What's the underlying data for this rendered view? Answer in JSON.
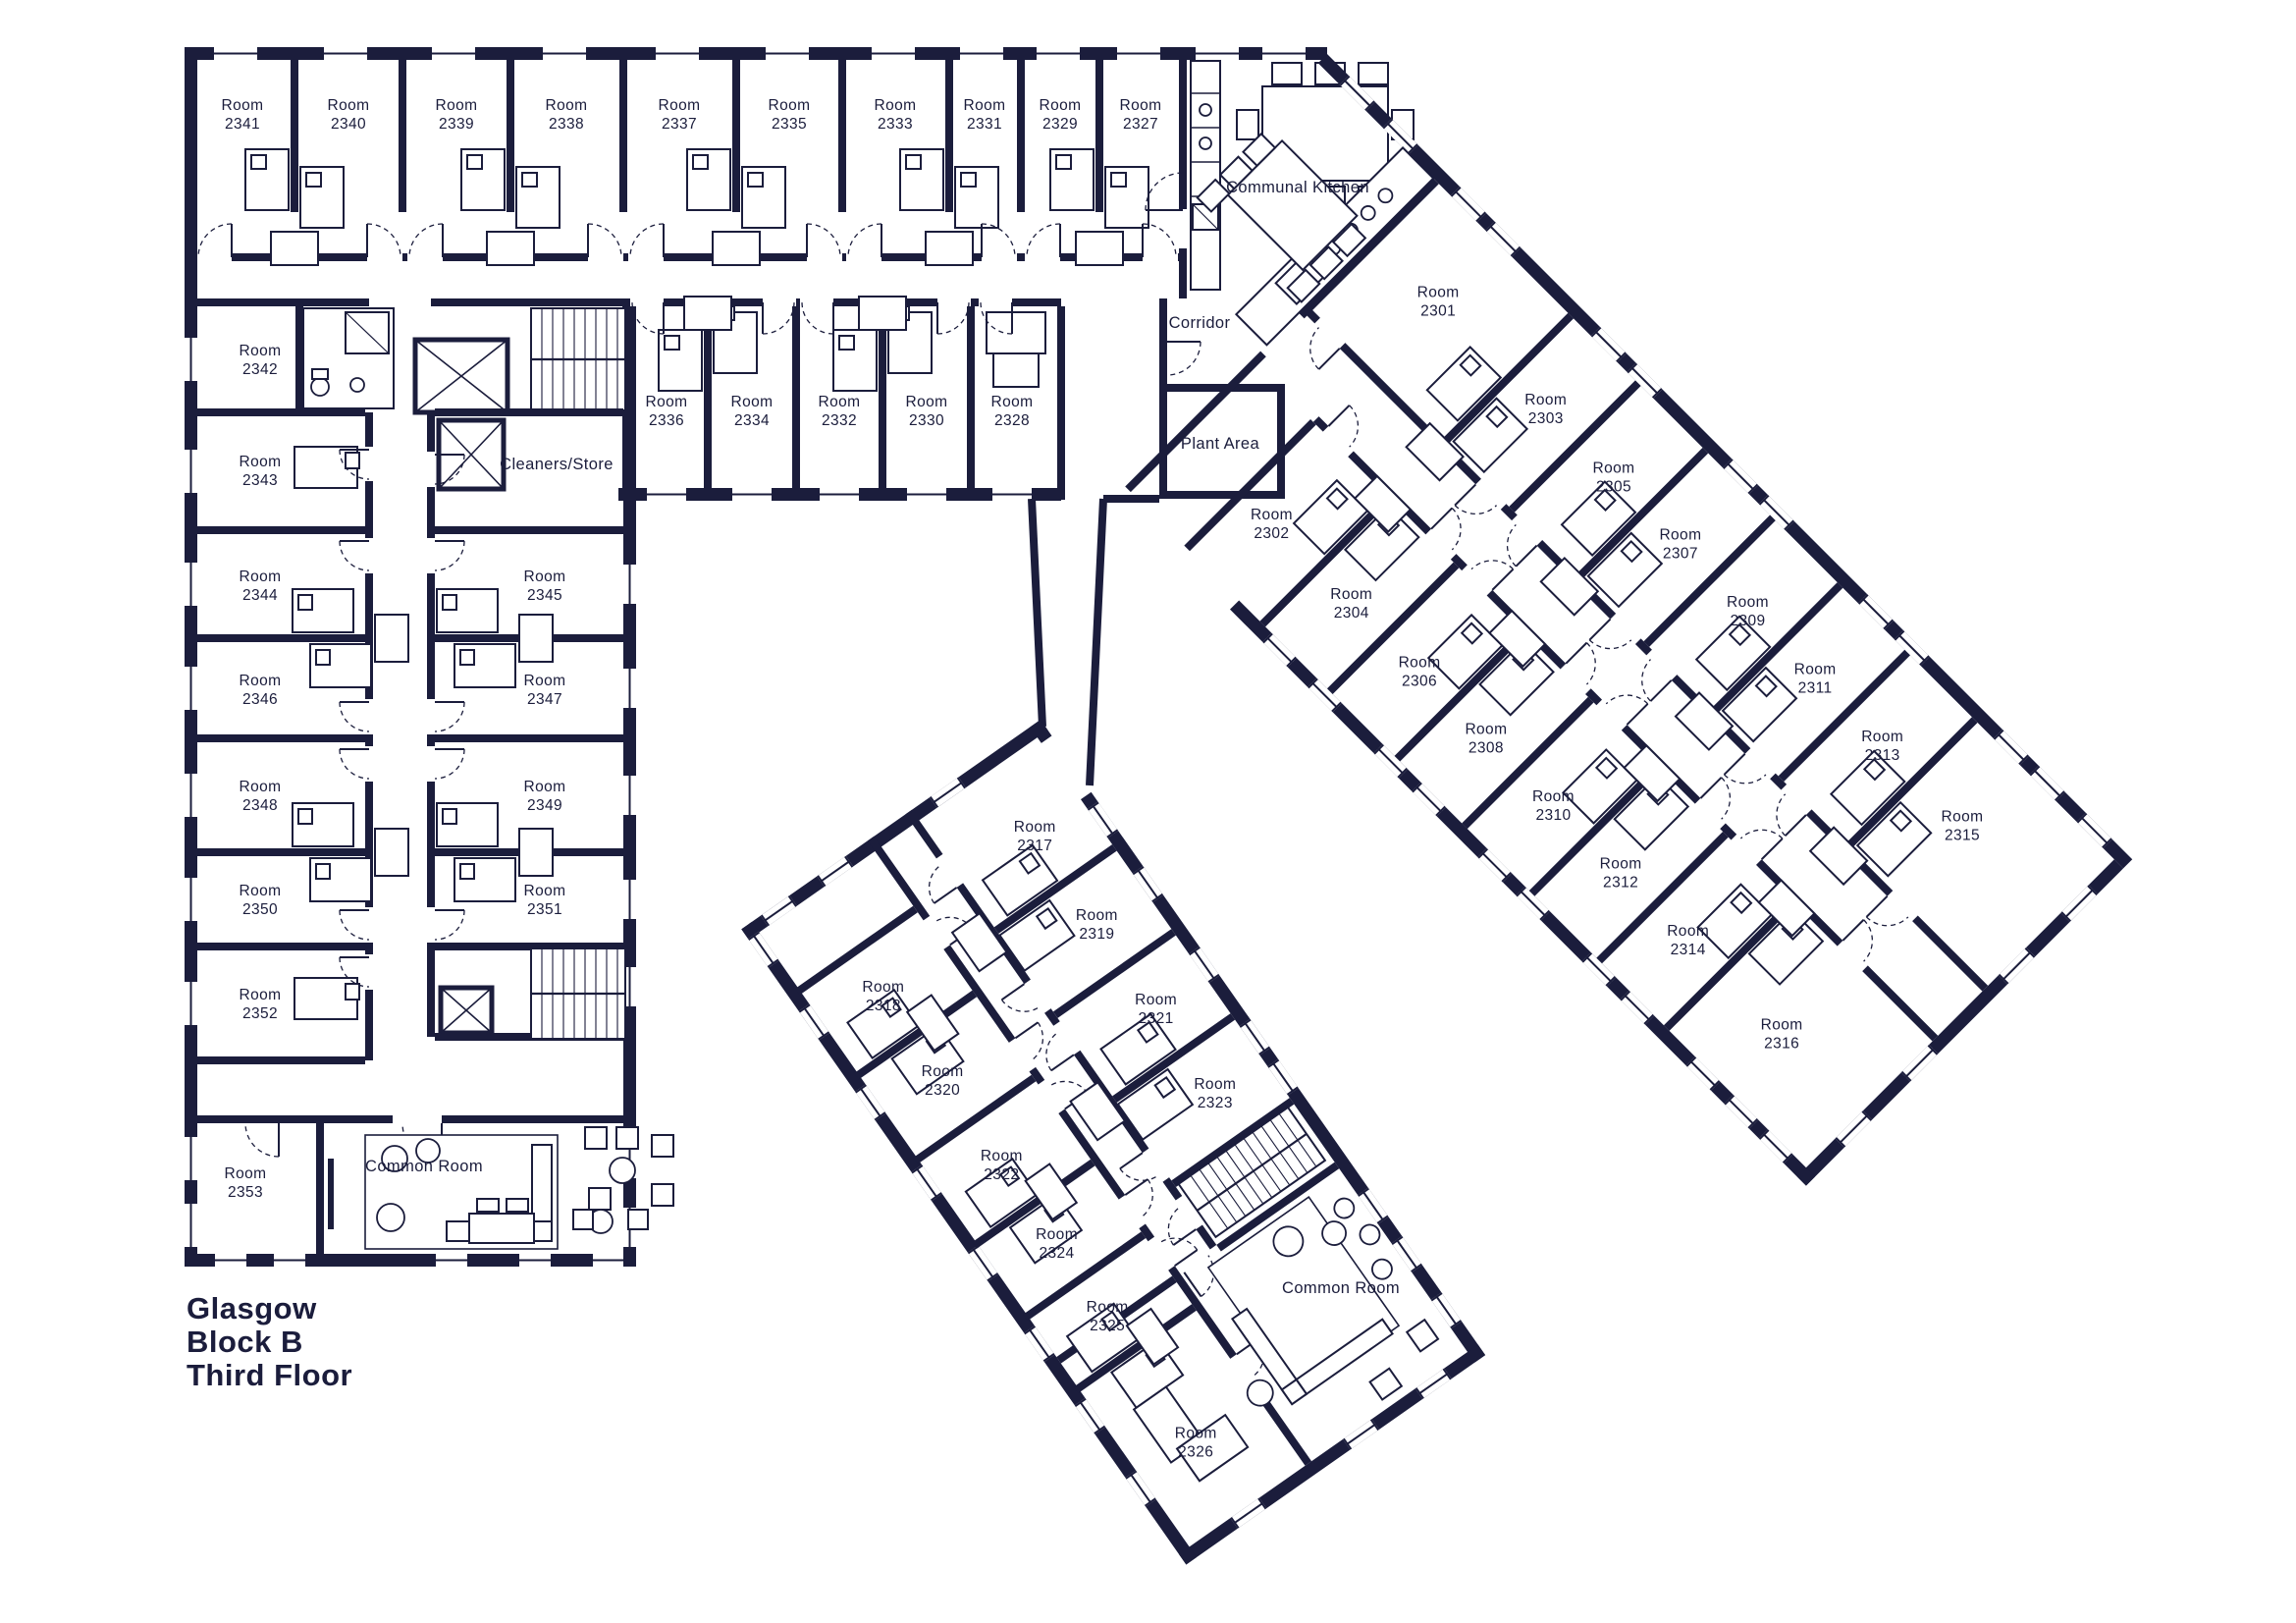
{
  "title": {
    "line1": "Glasgow",
    "line2": "Block B",
    "line3": "Third Floor"
  },
  "areas": {
    "room_word": "Room",
    "communal_kitchen": "Communal Kitchen",
    "corridor": "Corridor",
    "plant_area": "Plant Area",
    "cleaners_store": "Cleaners/Store",
    "common_room_left": "Common Room",
    "common_room_bottom": "Common Room"
  },
  "rooms": {
    "top_row": [
      "2341",
      "2340",
      "2339",
      "2338",
      "2337",
      "2335",
      "2333",
      "2331",
      "2329",
      "2327"
    ],
    "second_row": [
      "2336",
      "2334",
      "2332",
      "2330",
      "2328"
    ],
    "left_wing_west": [
      "2342",
      "2343",
      "2344",
      "2346",
      "2348",
      "2350",
      "2352"
    ],
    "left_wing_corner": "2353",
    "left_wing_east": [
      "2345",
      "2347",
      "2349",
      "2351"
    ],
    "right_wing_ne": [
      "2301",
      "2303",
      "2305",
      "2307",
      "2309",
      "2311",
      "2313",
      "2315"
    ],
    "right_wing_sw": [
      "2302",
      "2304",
      "2306",
      "2308",
      "2310",
      "2312",
      "2314",
      "2316"
    ],
    "bottom_wing_ne": [
      "2317",
      "2319",
      "2321",
      "2323"
    ],
    "bottom_wing_sw": [
      "2318",
      "2320",
      "2322",
      "2324",
      "2325",
      "2326"
    ]
  },
  "colors": {
    "wall": "#1b1d3c",
    "background": "#ffffff"
  }
}
